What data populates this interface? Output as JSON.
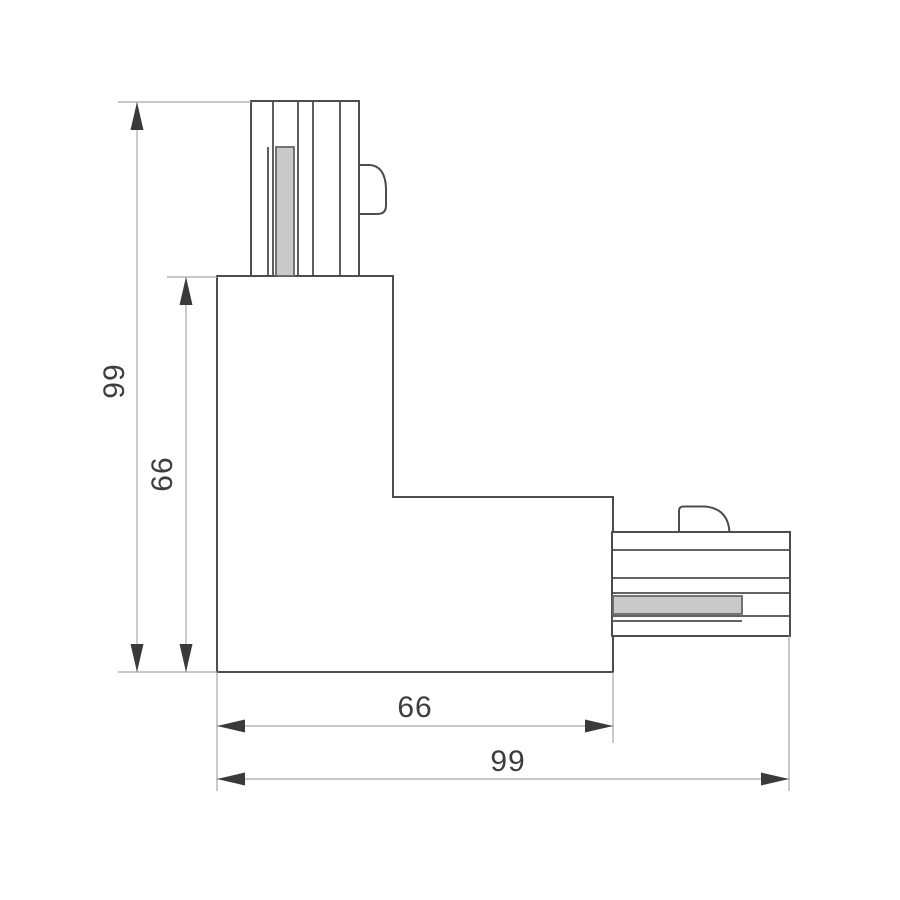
{
  "drawing": {
    "title": "L-shaped track connector dimension drawing",
    "dimensions": {
      "left_outer": {
        "label": "99"
      },
      "left_inner": {
        "label": "66"
      },
      "bottom_inner": {
        "label": "66"
      },
      "bottom_outer": {
        "label": "99"
      }
    },
    "colors": {
      "background": "#ffffff",
      "part_outline": "#4d4d4d",
      "contact_bar_fill": "#c9c9c9",
      "contact_bar_border": "#666666",
      "dimension_line": "#a6a6a6",
      "arrow_and_text": "#3a3a3a"
    }
  }
}
